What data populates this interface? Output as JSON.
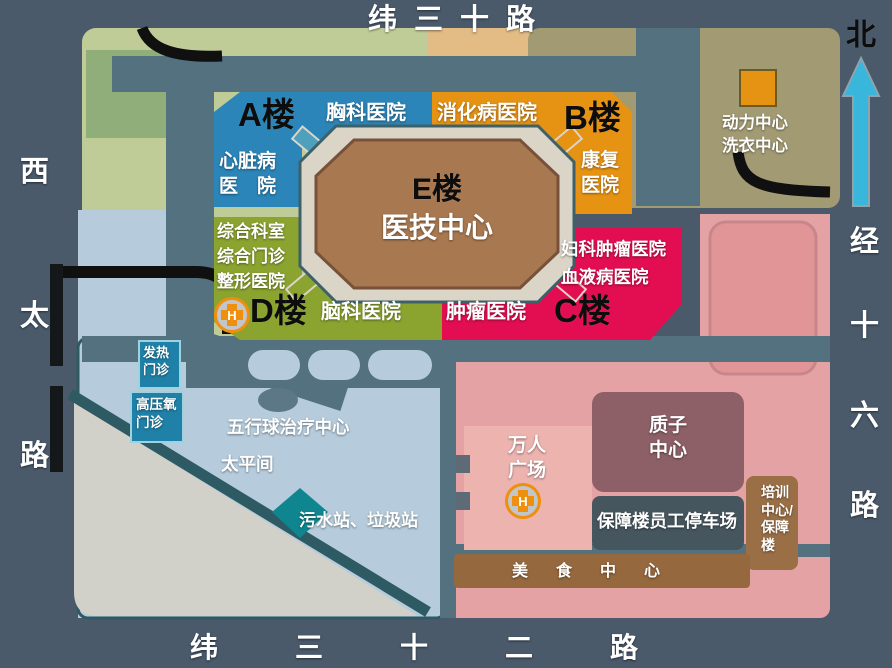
{
  "map": {
    "roads": {
      "top": "纬三十路",
      "bottom": [
        "纬",
        "三",
        "十",
        "二",
        "路"
      ],
      "left": [
        "西",
        "太",
        "路"
      ],
      "right": [
        "经",
        "十",
        "六",
        "路"
      ]
    },
    "compass": {
      "north": "北"
    },
    "buildings": {
      "a_label": "A楼",
      "chest": "胸科医院",
      "heart": "心脏病\n医　院",
      "b_label": "B楼",
      "digestive": "消化病医院",
      "rehab": "康复\n医院",
      "e_label": "E楼",
      "e_name": "医技中心",
      "comprehensive": "综合科室\n综合门诊\n整形医院",
      "d_label": "D楼",
      "brain": "脑科医院",
      "tumor": "肿瘤医院",
      "c_label": "C楼",
      "gyn_blood": "妇科肿瘤医院\n血液病医院",
      "power": "动力中心\n洗衣中心",
      "fever": "发热\n门诊",
      "hyperbaric": "高压氧\n门诊",
      "wuxing": "五行球治疗中心",
      "morgue": "太平间",
      "sewage": "污水站、垃圾站",
      "plaza": "万人\n广场",
      "proton": "质子\n中心",
      "parking": "保障楼员工停车场",
      "training": "培训\n中心/\n保障\n楼",
      "food": "美食中心"
    },
    "helipad_label": "H",
    "colors": {
      "a_blue": "#2B85B8",
      "b_orange": "#E69212",
      "c_crimson": "#E30D52",
      "d_olive": "#8BA32F",
      "e_brown": "#A87850",
      "ring_cream": "#DBD5C7",
      "arrow_cyan": "#39B6DB",
      "helipad_orange": "#EE8F0E"
    }
  }
}
